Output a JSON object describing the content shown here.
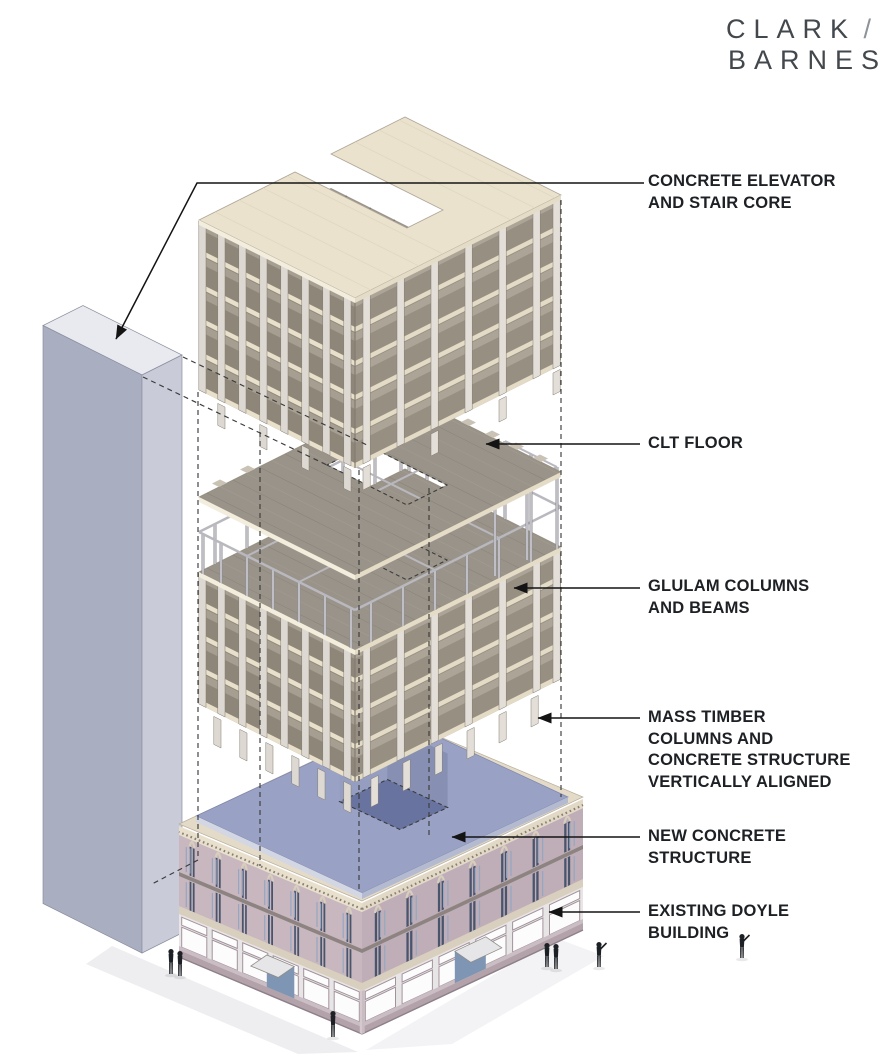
{
  "brand": {
    "line1": "CLARK",
    "slash": " /",
    "line2": "BARNES"
  },
  "annotations": [
    {
      "id": "concrete-core",
      "text": "CONCRETE ELEVATOR\nAND STAIR CORE"
    },
    {
      "id": "clt-floor",
      "text": "CLT FLOOR"
    },
    {
      "id": "glulam",
      "text": "GLULAM COLUMNS\nAND BEAMS"
    },
    {
      "id": "mass-timber",
      "text": "MASS TIMBER\nCOLUMNS AND\nCONCRETE STRUCTURE\nVERTICALLY ALIGNED"
    },
    {
      "id": "new-concrete",
      "text": "NEW CONCRETE\nSTRUCTURE"
    },
    {
      "id": "existing-doyle",
      "text": "EXISTING DOYLE\nBUILDING"
    }
  ],
  "colors": {
    "ink": "#1d2024",
    "leader": "#141414",
    "dash": "#3c3c3c",
    "cream": "#eae2cd",
    "band": "#e8e0cb",
    "band2": "#e3dbc5",
    "slab_edge_l": "#f3edde",
    "slab_edge_r": "#e4dcc7",
    "interior_l": "#8e8779",
    "interior_r": "#978f82",
    "ceil_l": "#a59e91",
    "ceil_r": "#aca496",
    "col": "#ddd9d2",
    "col2": "#e3dfd8",
    "col_s": "#837d71",
    "floor": "#9a938a",
    "plank": "#898276",
    "plank2": "#a49d91",
    "core_l": "#a9aec1",
    "core_r": "#c9ccd8",
    "core_t": "#e9eaef",
    "core_s": "#8b8f9f",
    "frame": "#b9b8be",
    "frame_d": "#8e8d92",
    "frame_l": "#cfcfd4",
    "blue": "#99a1c5",
    "blue_edge_l": "#d3d7e3",
    "blue_edge_r": "#b4bad0",
    "hole": "#68739f",
    "wall_a": "#959ec0",
    "wall_b": "#8790b2",
    "cornice": "#e3dac8",
    "dentil": "#8a7f70",
    "pier": "#c8b7bf",
    "pier2": "#bfaeb7",
    "spandrel": "#8d8481",
    "sill": "#d9cfbf",
    "win": "#49556d",
    "glass": "#93a7c2",
    "storefront_bg": "#e8e5e6",
    "glass_white": "#fcfcfd",
    "mullion": "#a2939b",
    "bulkhead": "#cbbdc4",
    "base": "#b3a2aa",
    "entry": "#7e95b4",
    "awning": "#e6e6e8",
    "shadow": "#eeeef1"
  }
}
